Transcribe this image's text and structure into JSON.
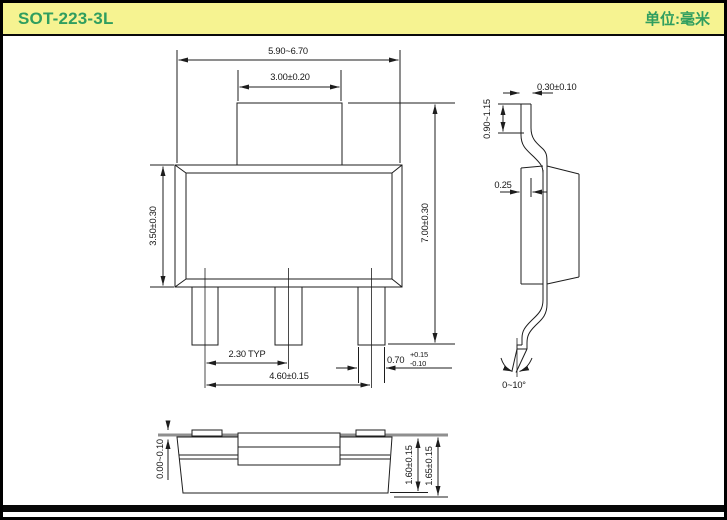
{
  "header": {
    "title": "SOT-223-3L",
    "unit_label": "单位:毫米"
  },
  "colors": {
    "header_bg": "#f6f391",
    "header_text": "#2f9e5f",
    "line": "#1d1d1d",
    "seating_plane_gray": "#8f8f8f"
  },
  "views": {
    "front": {
      "dims": {
        "overall_width": "5.90~6.70",
        "tab_width": "3.00±0.20",
        "body_height": "3.50±0.30",
        "overall_height": "7.00±0.30",
        "lead_pitch": "2.30 TYP",
        "lead_span": "4.60±0.15",
        "lead_width_value": "0.70",
        "lead_width_tol_plus": "+0.15",
        "lead_width_tol_minus": "-0.10"
      }
    },
    "side": {
      "dims": {
        "tab_thickness": "0.30±0.10",
        "tab_length": "0.90~1.15",
        "lead_offset": "0.25",
        "lead_angle": "0~10°"
      }
    },
    "bottom": {
      "dims": {
        "standoff": "0.00~0.10",
        "body_thickness": "1.60±0.15",
        "overall_thickness": "1.65±0.15"
      }
    }
  }
}
